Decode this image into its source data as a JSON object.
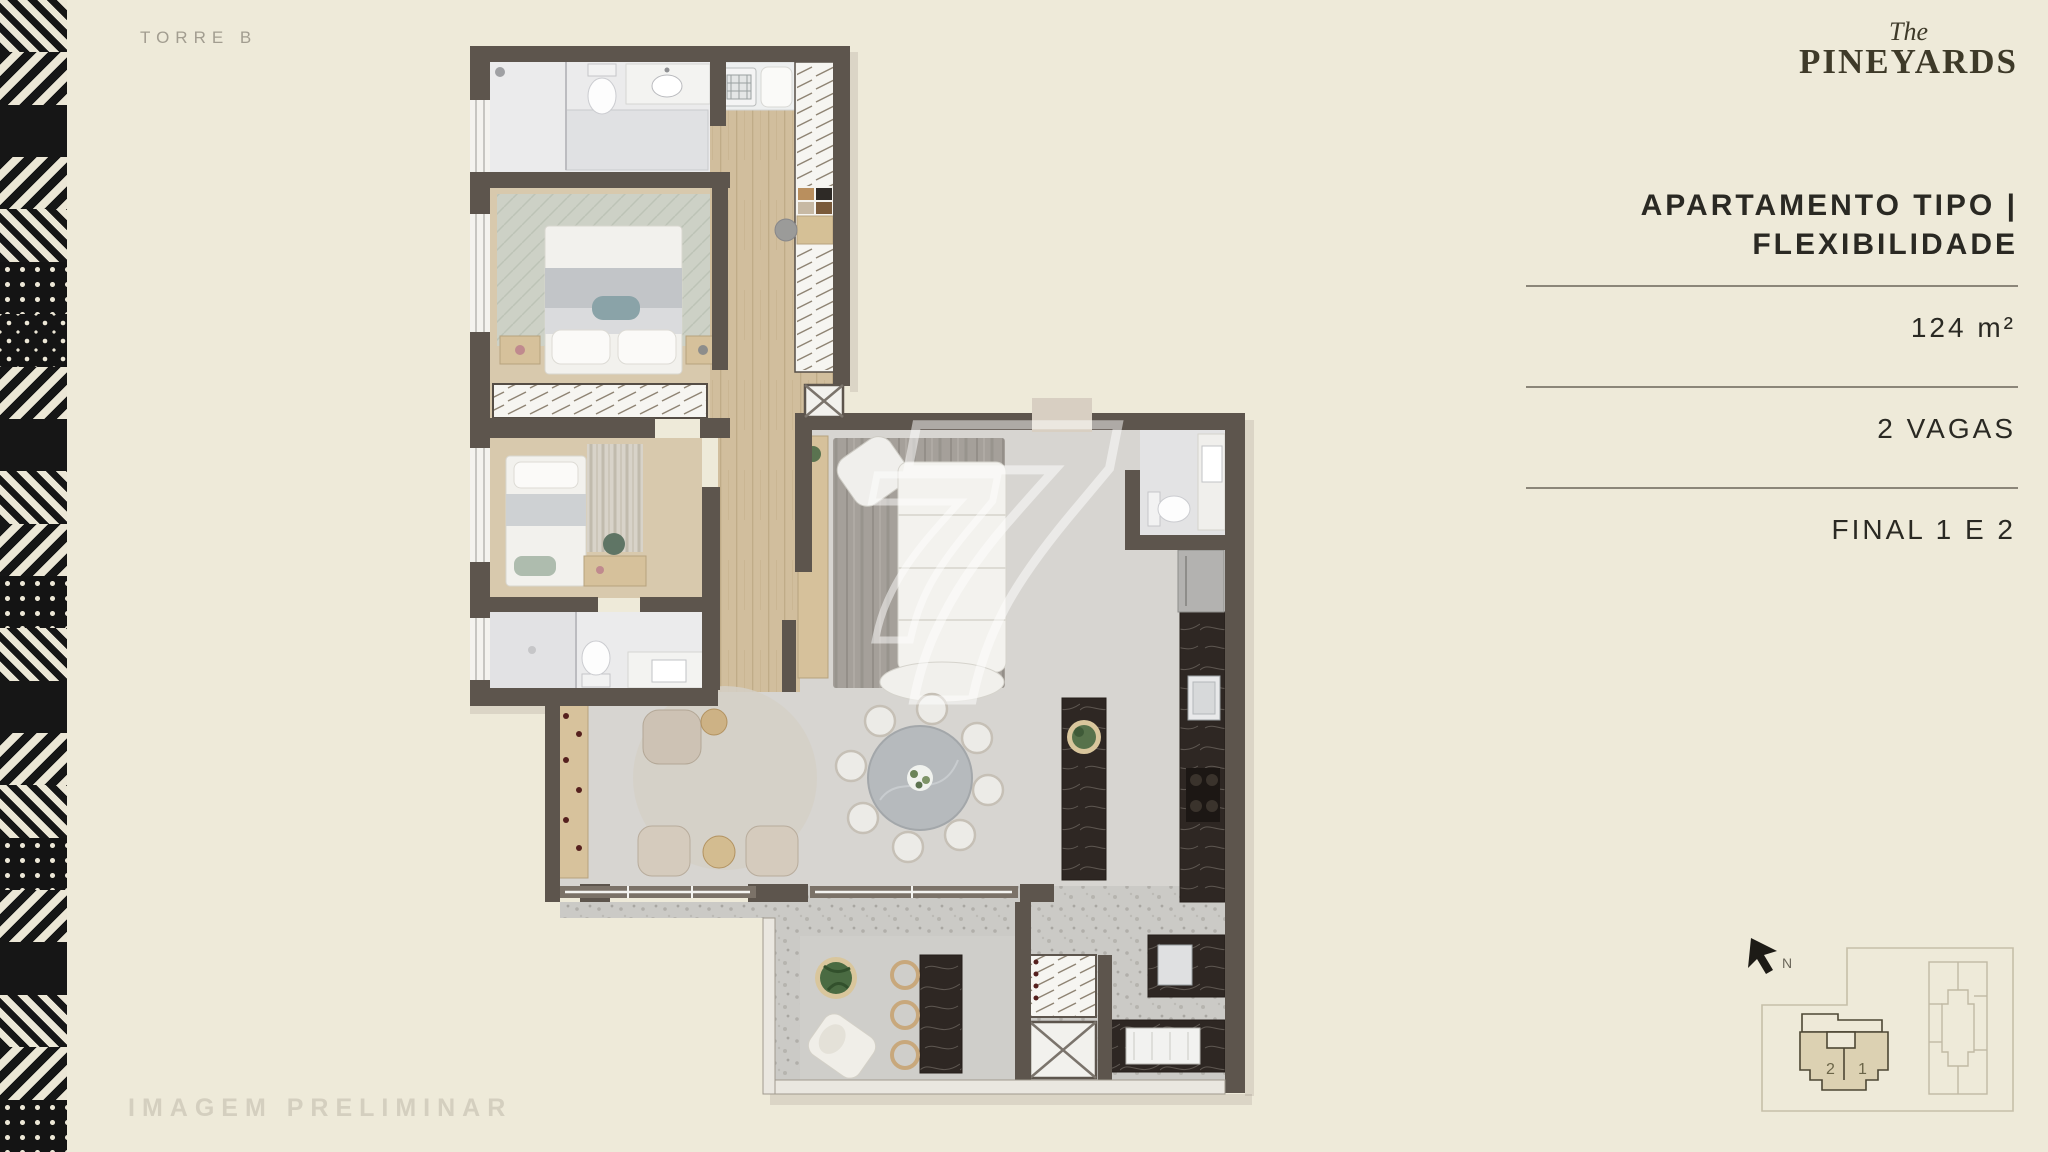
{
  "page": {
    "background_color": "#eeead9"
  },
  "header": {
    "tower_label": "TORRE B",
    "brand": {
      "prefix": "The",
      "name": "PINEYARDS",
      "color": "#3e3a29"
    }
  },
  "info_panel": {
    "title_line1": "APARTAMENTO TIPO |",
    "title_line2": "FLEXIBILIDADE",
    "rows": [
      {
        "label": "124 m²"
      },
      {
        "label": "2 VAGAS"
      },
      {
        "label": "FINAL 1 E 2"
      }
    ],
    "text_color": "#2a2923",
    "divider_color": "#8b8679"
  },
  "floor_plan": {
    "watermark_numeral": "7",
    "wall_color": "#5d554d",
    "wood_floor_color": "#d1be9d",
    "living_floor_color": "#d7d5d1"
  },
  "key_plan": {
    "north_label": "N",
    "unit_labels": [
      "2",
      "1"
    ],
    "highlight_color": "#dcd1b2",
    "outline_color": "#c6bfa9"
  },
  "footer": {
    "disclaimer": "IMAGEM PRELIMINAR"
  }
}
